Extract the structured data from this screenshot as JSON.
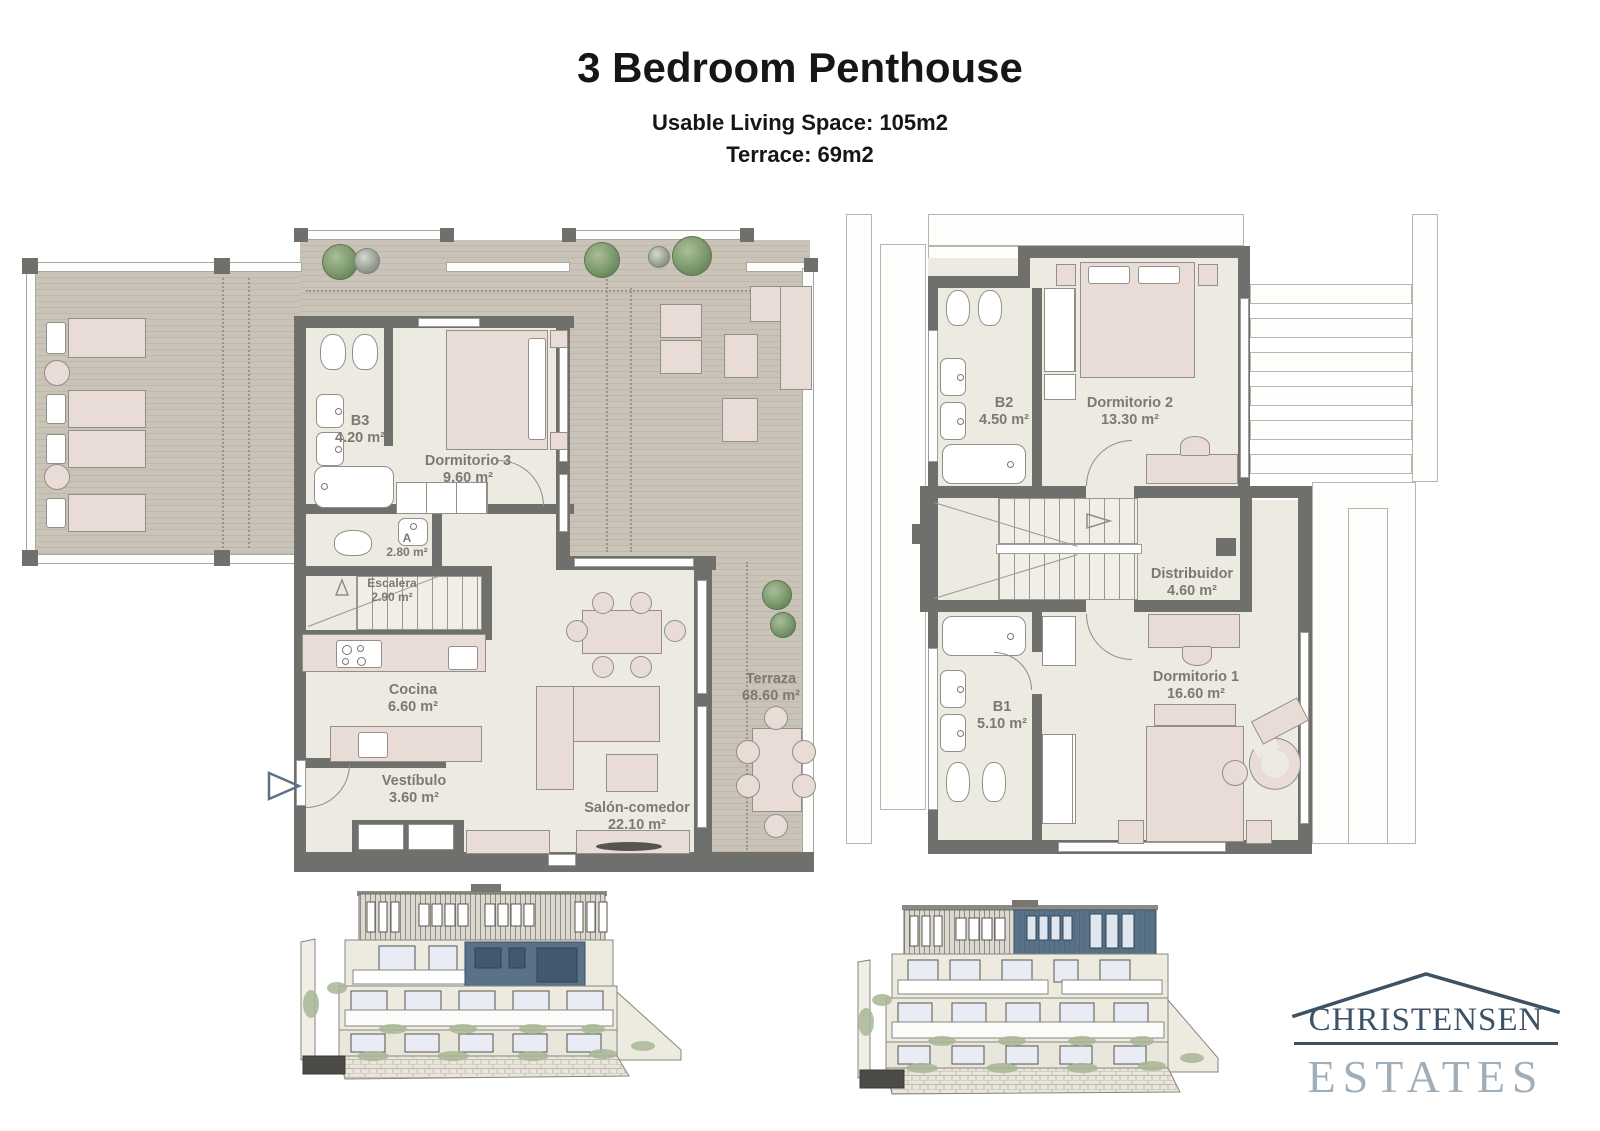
{
  "header": {
    "title": "3 Bedroom Penthouse",
    "subtitle_living": "Usable Living Space: 105m2",
    "subtitle_terrace": "Terrace: 69m2"
  },
  "plans": {
    "main": {
      "rooms": {
        "b3": {
          "name": "B3",
          "area": "4.20 m²"
        },
        "dorm3": {
          "name": "Dormitorio 3",
          "area": "9.60 m²"
        },
        "aseo": {
          "name": "A",
          "area": "2.80 m²"
        },
        "escalera": {
          "name": "Escalera",
          "area": "2.90 m²"
        },
        "cocina": {
          "name": "Cocina",
          "area": "6.60 m²"
        },
        "vestibulo": {
          "name": "Vestíbulo",
          "area": "3.60 m²"
        },
        "salon": {
          "name": "Salón-comedor",
          "area": "22.10 m²"
        },
        "terraza": {
          "name": "Terraza",
          "area": "68.60 m²"
        }
      }
    },
    "upper": {
      "rooms": {
        "b2": {
          "name": "B2",
          "area": "4.50 m²"
        },
        "dorm2": {
          "name": "Dormitorio 2",
          "area": "13.30 m²"
        },
        "distribuidor": {
          "name": "Distribuidor",
          "area": "4.60 m²"
        },
        "b1": {
          "name": "B1",
          "area": "5.10 m²"
        },
        "dorm1": {
          "name": "Dormitorio 1",
          "area": "16.60 m²"
        }
      }
    }
  },
  "logo": {
    "line1": "CHRISTENSEN",
    "line2": "ESTATES"
  },
  "colors": {
    "wall": "#6f6f6b",
    "interior_floor": "#edeae2",
    "deck": "#c7c0b5",
    "furniture": "#e9dbd6",
    "fixture": "#ffffff",
    "plant_green": "#7b986c",
    "accent_blue": "#5a7288",
    "elevation_window": "#dfe4ee",
    "logo_dark": "#3d5264",
    "logo_light": "#a0aeb9"
  }
}
